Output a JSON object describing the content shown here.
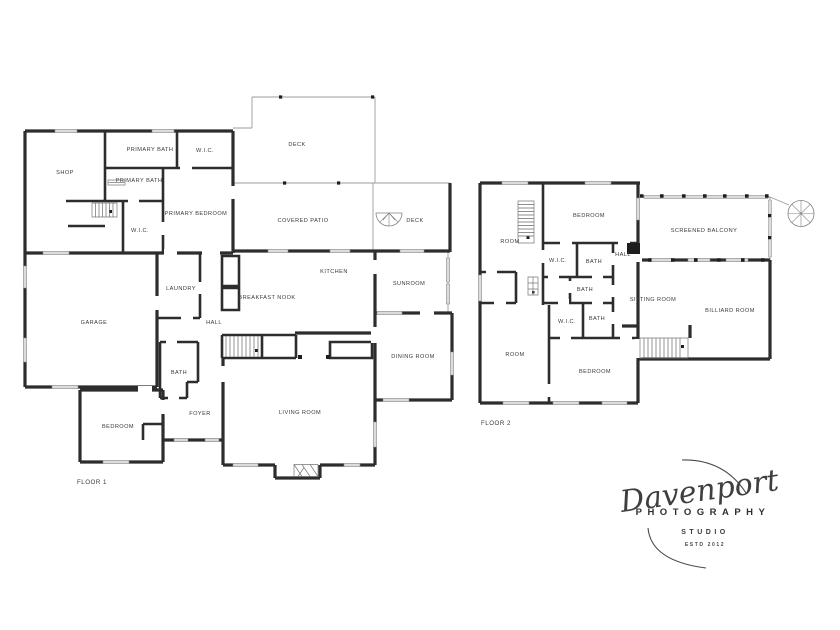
{
  "colors": {
    "background": "#ffffff",
    "wall": "#2d2d2d",
    "thin_line": "#9b9b9b",
    "window_fill": "#dcdcdc",
    "label_text": "#3a3a3a",
    "logo": "#454545"
  },
  "floor1": {
    "label": "FLOOR 1",
    "rooms": {
      "shop": "SHOP",
      "primary_bath_upper": "PRIMARY BATH",
      "wic_upper": "W.I.C.",
      "primary_bath_lower": "PRIMARY BATH",
      "primary_bedroom": "PRIMARY BEDROOM",
      "wic_lower": "W.I.C.",
      "deck_top": "DECK",
      "covered_patio": "COVERED PATIO",
      "deck_right": "DECK",
      "kitchen": "KITCHEN",
      "breakfast_nook": "BREAKFAST NOOK",
      "laundry": "LAUNDRY",
      "hall": "HALL",
      "sunroom": "SUNROOM",
      "dining_room": "DINING ROOM",
      "garage": "GARAGE",
      "bath": "BATH",
      "foyer": "FOYER",
      "bedroom": "BEDROOM",
      "living_room": "LIVING ROOM"
    }
  },
  "floor2": {
    "label": "FLOOR 2",
    "rooms": {
      "room_upper": "ROOM",
      "bedroom_upper": "BEDROOM",
      "wic_upper": "W.I.C.",
      "bath_upper": "BATH",
      "hall": "HALL",
      "bath_middle": "BATH",
      "wic_lower": "W.I.C.",
      "bath_lower": "BATH",
      "screened_balcony": "SCREENED BALCONY",
      "sitting_room": "SITTING ROOM",
      "billiard_room": "BILLIARD ROOM",
      "room_lower": "ROOM",
      "bedroom_lower": "BEDROOM"
    }
  },
  "watermark": {
    "studio_name": "Davenport",
    "subtitle": "PHOTOGRAPHY",
    "tagline": "STUDIO",
    "established": "ESTD 2012"
  }
}
